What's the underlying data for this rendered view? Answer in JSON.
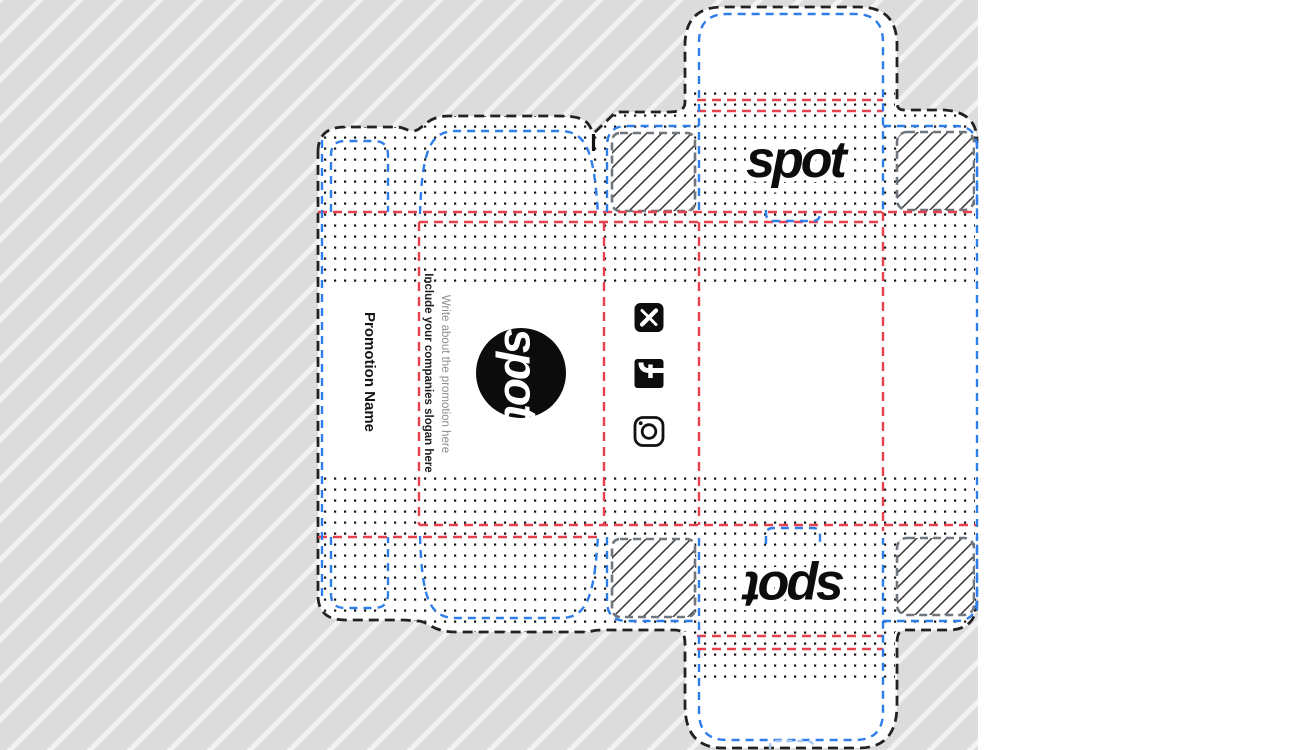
{
  "artboard": {
    "background": "#dcdcdc",
    "stripe_color": "#ffffff"
  },
  "dieline": {
    "cut_line_color": "#222222",
    "fold_line_color": "#2e7de9",
    "crease_line_color": "#e8414e",
    "glue_flap_border_color": "#70767d",
    "hatch_color": "#3f3f3f",
    "dot_color": "#151515",
    "notch_color": "#a9c9f2"
  },
  "branding": {
    "logo_top": "spot",
    "logo_bottom": "spot",
    "logo_badge": "spot",
    "promotion_name": "Promotion Name",
    "slogan_bold": "Include your companies slogan here",
    "slogan_light": "Write about the promotion here"
  },
  "social": {
    "icons": [
      {
        "name": "x-icon"
      },
      {
        "name": "facebook-icon"
      },
      {
        "name": "instagram-icon"
      }
    ]
  }
}
